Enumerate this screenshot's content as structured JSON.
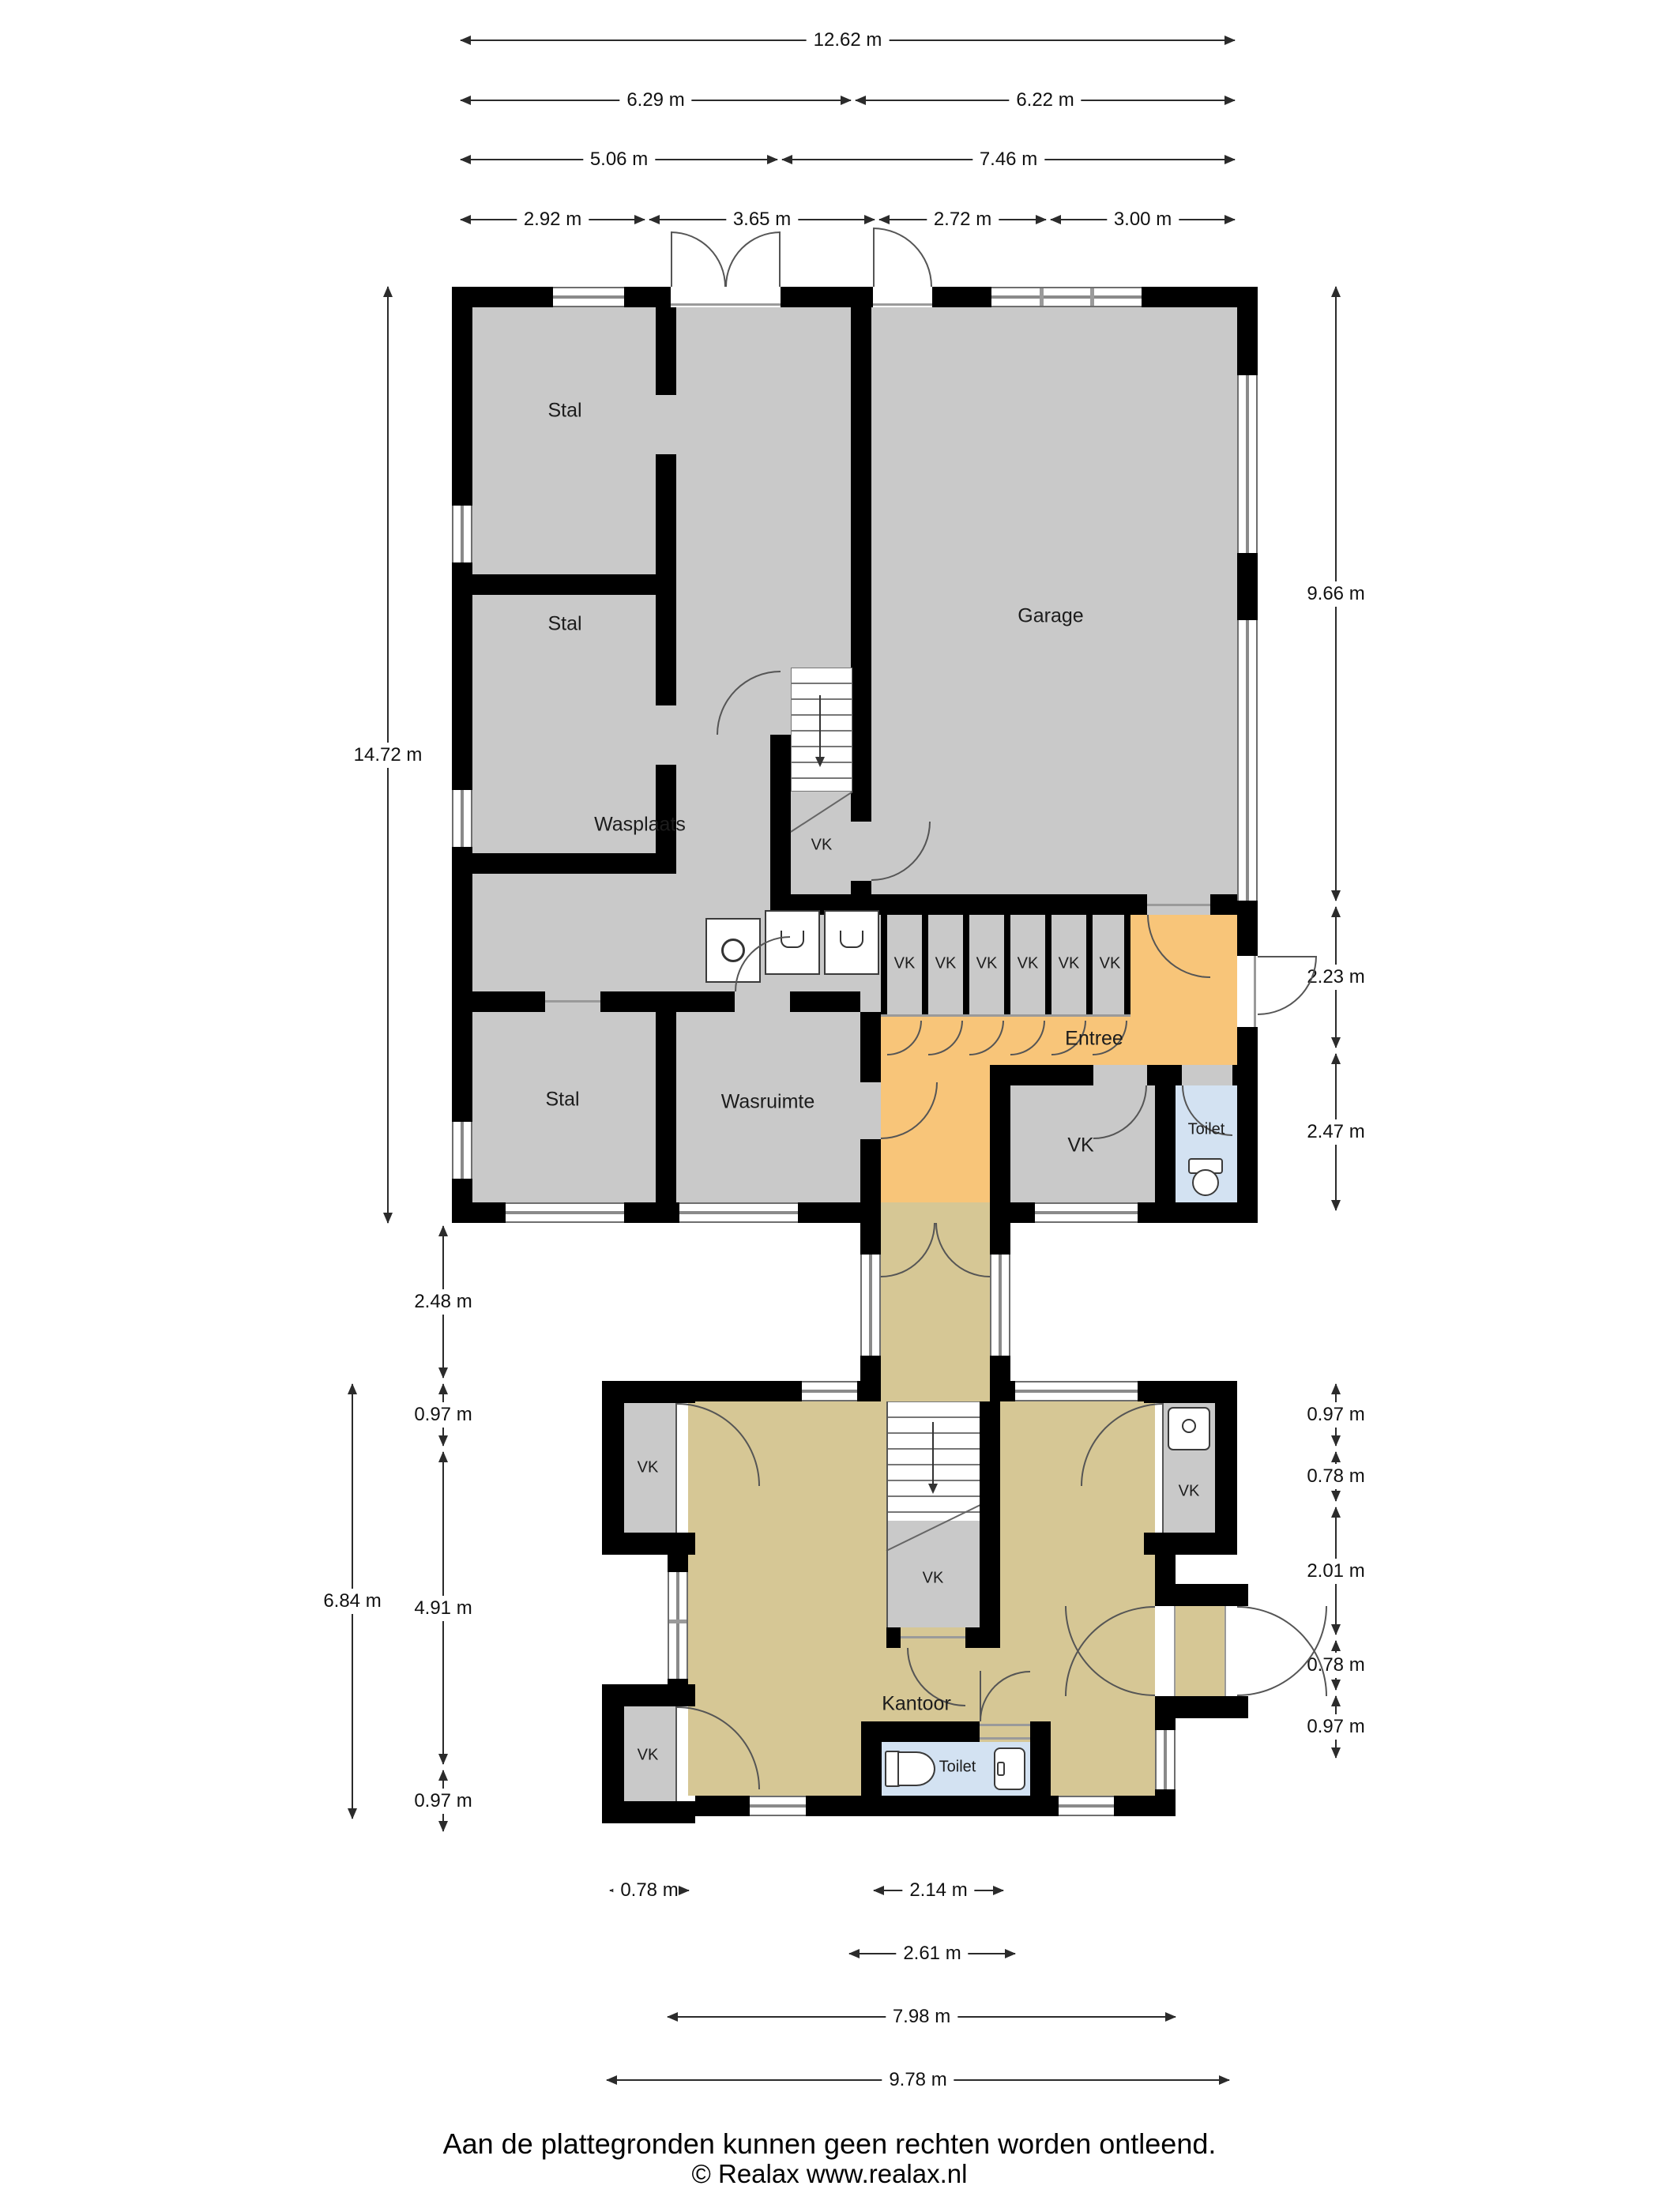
{
  "dims": {
    "w_total": "12.62 m",
    "w_left": "6.29 m",
    "w_right": "6.22 m",
    "w_a": "5.06 m",
    "w_b": "7.46 m",
    "w_s1": "2.92 m",
    "w_s2": "3.65 m",
    "w_s3": "2.72 m",
    "w_s4": "3.00 m",
    "h_main": "14.72 m",
    "h_gap": "2.48 m",
    "h_l097a": "0.97 m",
    "h_l491": "4.91 m",
    "h_l097b": "0.97 m",
    "h_l684": "6.84 m",
    "h_r966": "9.66 m",
    "h_r223": "2.23 m",
    "h_r247": "2.47 m",
    "h_r097a": "0.97 m",
    "h_r078a": "0.78 m",
    "h_r201": "2.01 m",
    "h_r078b": "0.78 m",
    "h_r097b": "0.97 m",
    "b_078": "0.78 m",
    "b_214": "2.14 m",
    "b_261": "2.61 m",
    "b_798": "7.98 m",
    "b_978": "9.78 m"
  },
  "rooms": {
    "stal": "Stal",
    "garage": "Garage",
    "wasplaats": "Wasplaats",
    "wasruimte": "Wasruimte",
    "entree": "Entree",
    "kantoor": "Kantoor",
    "toilet": "Toilet",
    "vk": "VK"
  },
  "footer": {
    "line1": "Aan de plattegronden kunnen geen rechten worden ontleend.",
    "line2": "© Realax www.realax.nl"
  },
  "colors": {
    "wall": "#000000",
    "room_gray": "#c9c9c9",
    "entree_orange": "#f8c579",
    "kantoor_tan": "#d6c795",
    "toilet_blue": "#d3e2f2"
  }
}
